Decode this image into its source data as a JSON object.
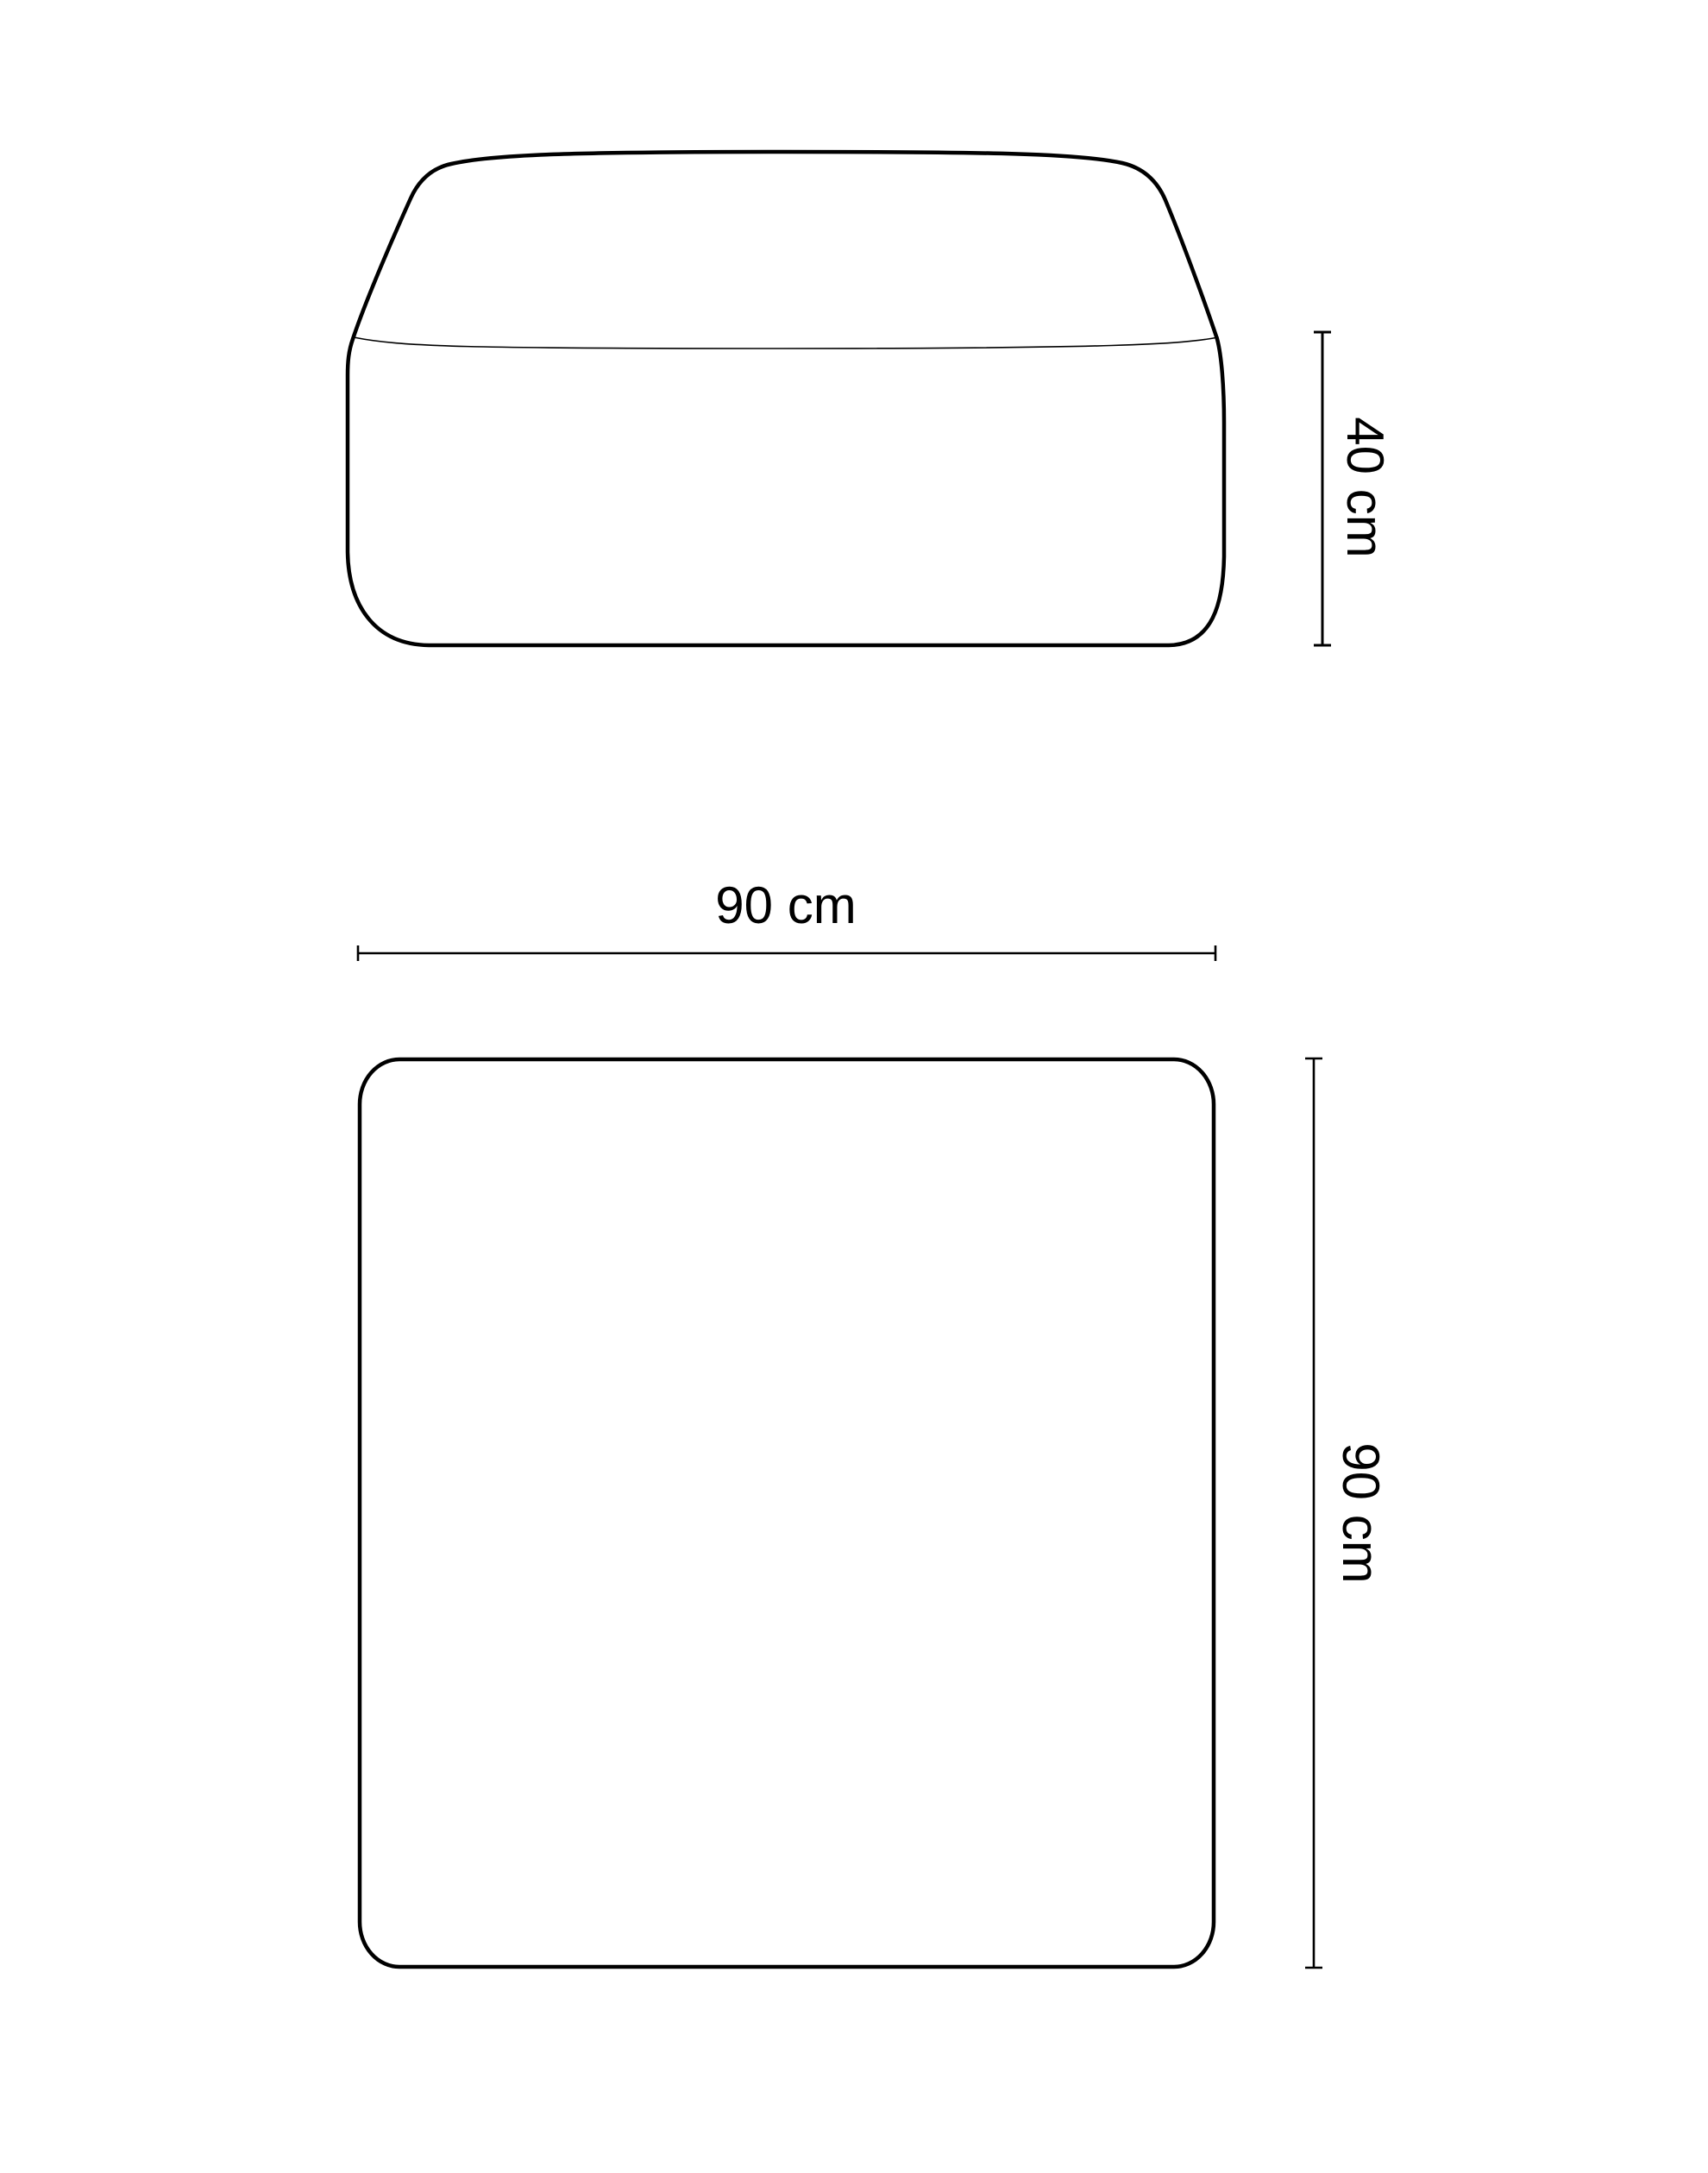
{
  "page": {
    "background_color": "#ffffff",
    "line_color": "#000000"
  },
  "diagram": {
    "type": "furniture-dimension-drawing",
    "views": {
      "front": {
        "description": "front elevation of rounded square pouf",
        "height_dimension": {
          "label": "40 cm",
          "orientation": "vertical"
        }
      },
      "top": {
        "description": "top plan view of rounded square pouf",
        "width_dimension": {
          "label": "90 cm",
          "orientation": "horizontal"
        },
        "depth_dimension": {
          "label": "90 cm",
          "orientation": "vertical"
        }
      }
    }
  }
}
